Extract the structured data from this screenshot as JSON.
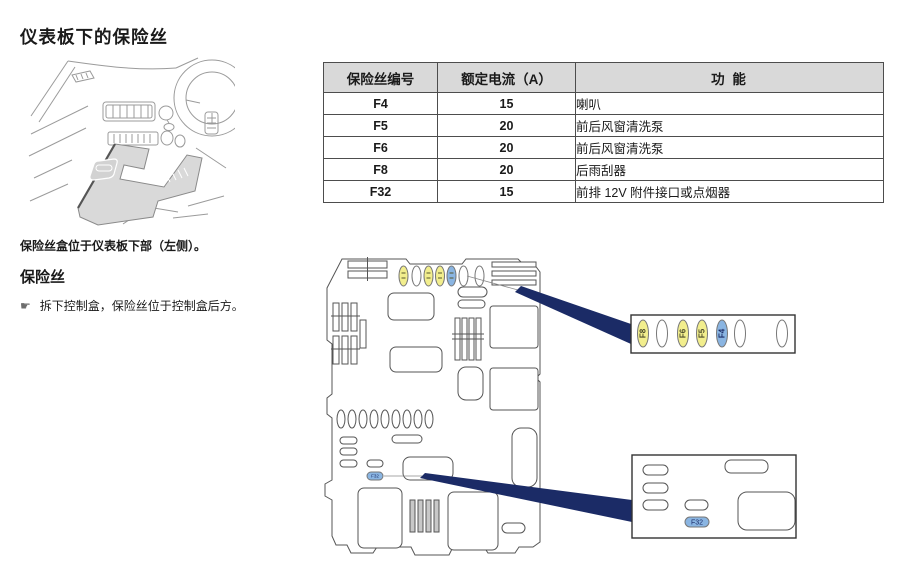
{
  "page": {
    "title": "仪表板下的保险丝",
    "caption": "保险丝盒位于仪表板下部（左侧）。",
    "section": {
      "heading": "保险丝",
      "bullet_icon": "☛",
      "bullet_text": "拆下控制盒，保险丝位于控制盒后方。"
    }
  },
  "fuse_table": {
    "headers": {
      "id": "保险丝编号",
      "amps": "额定电流（A）",
      "function": "功 能"
    },
    "rows": [
      {
        "id": "F4",
        "amps": "15",
        "function": "喇叭"
      },
      {
        "id": "F5",
        "amps": "20",
        "function": "前后风窗清洗泵"
      },
      {
        "id": "F6",
        "amps": "20",
        "function": "前后风窗清洗泵"
      },
      {
        "id": "F8",
        "amps": "20",
        "function": "后雨刮器"
      },
      {
        "id": "F32",
        "amps": "15",
        "function": "前排 12V 附件接口或点烟器"
      }
    ]
  },
  "diagram": {
    "main_box_f32_label": "F32",
    "inset_top_fuses": [
      {
        "label": "F8",
        "color": "#f2ee8d"
      },
      {
        "label": "",
        "color": "#ffffff"
      },
      {
        "label": "F6",
        "color": "#f2ee8d"
      },
      {
        "label": "F5",
        "color": "#f2ee8d"
      },
      {
        "label": "F4",
        "color": "#8ab5e2"
      },
      {
        "label": "",
        "color": "#ffffff"
      },
      {
        "label": "",
        "color": "#ffffff"
      }
    ],
    "inset_bottom_f32_label": "F32",
    "colors": {
      "fuse_yellow": "#f2ee8d",
      "fuse_blue": "#8ab5e2",
      "callout_navy": "#1b2b66",
      "table_header_bg": "#d9d9d9"
    }
  }
}
